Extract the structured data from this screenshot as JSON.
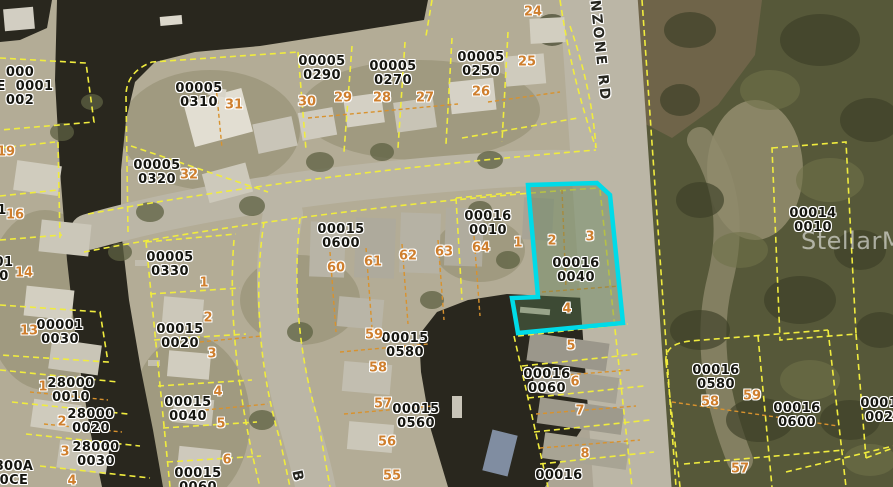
{
  "colors": {
    "land": "#b3ac96",
    "water": "#29271e",
    "preserve": "#565839",
    "pond": "#6f6449",
    "road": "#bbb6a6",
    "parcel-line": "#f0ec3e",
    "lot-line": "#d8922e",
    "highlight": "#00dbe8",
    "label-text": "#15150f",
    "lot-text": "#cf7f2e"
  },
  "map": {
    "watermark": "StellarMLS",
    "highlight_parcel": {
      "parcel_id": "00016 0040",
      "lot_numbers": [
        "2",
        "3",
        "4"
      ],
      "outline_color": "#00dbe8"
    },
    "road_labels": [
      {
        "text": "ANZONE RD",
        "x": 600,
        "y": -14,
        "rot": 84
      },
      {
        "text": "B",
        "x": 303,
        "y": 469,
        "rot": 78
      }
    ],
    "parcel_labels": [
      {
        "lines": [
          "000",
          "CE  0001",
          "002"
        ],
        "cx": 20,
        "cy": 87
      },
      {
        "lines": [
          "00005",
          "0310"
        ],
        "cx": 199,
        "cy": 96
      },
      {
        "lines": [
          "00005",
          "0320"
        ],
        "cx": 157,
        "cy": 173
      },
      {
        "lines": [
          "00005",
          "0290"
        ],
        "cx": 322,
        "cy": 69
      },
      {
        "lines": [
          "00005",
          "0270"
        ],
        "cx": 393,
        "cy": 74
      },
      {
        "lines": [
          "00005",
          "0250"
        ],
        "cx": 481,
        "cy": 65
      },
      {
        "lines": [
          "00005",
          "0330"
        ],
        "cx": 170,
        "cy": 265
      },
      {
        "lines": [
          "00001",
          "0030"
        ],
        "cx": 60,
        "cy": 333
      },
      {
        "lines": [
          "00015",
          "0020"
        ],
        "cx": 180,
        "cy": 337
      },
      {
        "lines": [
          "00015",
          "0040"
        ],
        "cx": 188,
        "cy": 410
      },
      {
        "lines": [
          "00015",
          "0060"
        ],
        "cx": 198,
        "cy": 481
      },
      {
        "lines": [
          "28000",
          "0010"
        ],
        "cx": 71,
        "cy": 391
      },
      {
        "lines": [
          "28000",
          "0020"
        ],
        "cx": 91,
        "cy": 422
      },
      {
        "lines": [
          "28000",
          "0030"
        ],
        "cx": 96,
        "cy": 455
      },
      {
        "lines": [
          "800A",
          "0CE"
        ],
        "cx": 14,
        "cy": 474
      },
      {
        "lines": [
          "01",
          "0"
        ],
        "cx": 4,
        "cy": 270
      },
      {
        "lines": [
          "1"
        ],
        "cx": 2,
        "cy": 211
      },
      {
        "lines": [
          "00015",
          "0600"
        ],
        "cx": 341,
        "cy": 237
      },
      {
        "lines": [
          "00016",
          "0010"
        ],
        "cx": 488,
        "cy": 224
      },
      {
        "lines": [
          "00016",
          "0040"
        ],
        "cx": 576,
        "cy": 271
      },
      {
        "lines": [
          "00015",
          "0580"
        ],
        "cx": 405,
        "cy": 346
      },
      {
        "lines": [
          "00015",
          "0560"
        ],
        "cx": 416,
        "cy": 417
      },
      {
        "lines": [
          "00016",
          "0060"
        ],
        "cx": 547,
        "cy": 382
      },
      {
        "lines": [
          "00016"
        ],
        "cx": 559,
        "cy": 476
      },
      {
        "lines": [
          "00016",
          "0580"
        ],
        "cx": 716,
        "cy": 378
      },
      {
        "lines": [
          "00016",
          "0600"
        ],
        "cx": 797,
        "cy": 416
      },
      {
        "lines": [
          "00016",
          "0020"
        ],
        "cx": 884,
        "cy": 411
      },
      {
        "lines": [
          "00014",
          "0010"
        ],
        "cx": 813,
        "cy": 221
      }
    ],
    "lot_numbers": [
      {
        "t": "24",
        "cx": 533,
        "cy": 12
      },
      {
        "t": "25",
        "cx": 527,
        "cy": 62
      },
      {
        "t": "26",
        "cx": 481,
        "cy": 92
      },
      {
        "t": "27",
        "cx": 425,
        "cy": 98
      },
      {
        "t": "28",
        "cx": 382,
        "cy": 98
      },
      {
        "t": "29",
        "cx": 343,
        "cy": 98
      },
      {
        "t": "30",
        "cx": 307,
        "cy": 102
      },
      {
        "t": "31",
        "cx": 234,
        "cy": 105
      },
      {
        "t": "32",
        "cx": 189,
        "cy": 175
      },
      {
        "t": "19",
        "cx": 6,
        "cy": 152
      },
      {
        "t": "16",
        "cx": 15,
        "cy": 215
      },
      {
        "t": "14",
        "cx": 24,
        "cy": 273
      },
      {
        "t": "13",
        "cx": 29,
        "cy": 331
      },
      {
        "t": "1",
        "cx": 43,
        "cy": 387
      },
      {
        "t": "2",
        "cx": 62,
        "cy": 422
      },
      {
        "t": "3",
        "cx": 65,
        "cy": 452
      },
      {
        "t": "4",
        "cx": 72,
        "cy": 481
      },
      {
        "t": "1",
        "cx": 204,
        "cy": 283
      },
      {
        "t": "2",
        "cx": 208,
        "cy": 318
      },
      {
        "t": "3",
        "cx": 212,
        "cy": 354
      },
      {
        "t": "4",
        "cx": 218,
        "cy": 392
      },
      {
        "t": "5",
        "cx": 221,
        "cy": 424
      },
      {
        "t": "6",
        "cx": 227,
        "cy": 460
      },
      {
        "t": "60",
        "cx": 336,
        "cy": 268
      },
      {
        "t": "61",
        "cx": 373,
        "cy": 262
      },
      {
        "t": "62",
        "cx": 408,
        "cy": 256
      },
      {
        "t": "63",
        "cx": 444,
        "cy": 252
      },
      {
        "t": "64",
        "cx": 481,
        "cy": 248
      },
      {
        "t": "1",
        "cx": 518,
        "cy": 243
      },
      {
        "t": "2",
        "cx": 552,
        "cy": 241
      },
      {
        "t": "3",
        "cx": 590,
        "cy": 237
      },
      {
        "t": "4",
        "cx": 567,
        "cy": 309
      },
      {
        "t": "5",
        "cx": 571,
        "cy": 346
      },
      {
        "t": "6",
        "cx": 575,
        "cy": 382
      },
      {
        "t": "7",
        "cx": 580,
        "cy": 411
      },
      {
        "t": "8",
        "cx": 585,
        "cy": 454
      },
      {
        "t": "59",
        "cx": 374,
        "cy": 335
      },
      {
        "t": "58",
        "cx": 378,
        "cy": 368
      },
      {
        "t": "57",
        "cx": 383,
        "cy": 404
      },
      {
        "t": "56",
        "cx": 387,
        "cy": 442
      },
      {
        "t": "55",
        "cx": 392,
        "cy": 476
      },
      {
        "t": "58",
        "cx": 710,
        "cy": 402
      },
      {
        "t": "59",
        "cx": 752,
        "cy": 396
      },
      {
        "t": "57",
        "cx": 740,
        "cy": 469
      }
    ]
  }
}
